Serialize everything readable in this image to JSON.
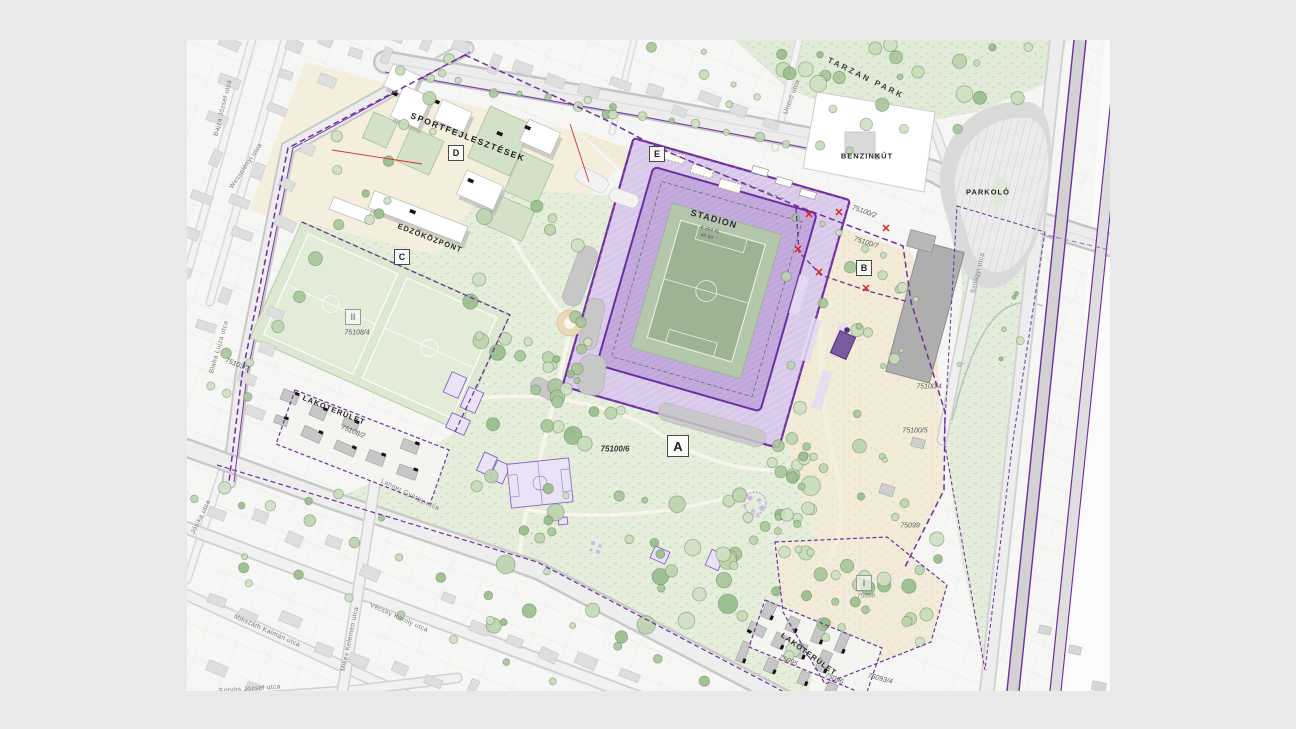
{
  "areas": {
    "sport": {
      "label": "SPORTFEJLESZTÉSEK"
    },
    "training": {
      "label": "EDZŐKÖZPONT"
    },
    "stadium": {
      "label": "STADION",
      "note1": "8 903 fő",
      "note2": "±0,00"
    },
    "residential_left": {
      "label": "LAKÓTERÜLET"
    },
    "residential_se": {
      "label": "LAKÓTERÜLET"
    },
    "gas_station": {
      "label": "BENZINKÚT"
    },
    "parking": {
      "label": "PARKOLÓ"
    },
    "tarzan_park": {
      "label": "TARZAN PARK"
    }
  },
  "zone_markers": {
    "a": "A",
    "b": "B",
    "c": "C",
    "d": "D",
    "e": "E",
    "one": "I",
    "two": "II"
  },
  "parcels": {
    "p75100_2": "75100/2",
    "p75100_7": "75100/7",
    "p75100_4": "75100/4",
    "p75100_5": "75100/5",
    "p75100_6": "75100/6",
    "p75108_4": "75108/4",
    "p75108_2": "75108/2",
    "p75103_3": "75103/3",
    "p75099": "75099",
    "p75098": "75098",
    "p75095": "75095",
    "p75096": "75096",
    "p75093_4": "75093/4"
  },
  "streets": {
    "bajza": "Bajza József utca",
    "wesselenyi": "Wesselényi utca",
    "blaha": "Blaha Lujza utca",
    "josika": "Jósika utca",
    "lahner": "Lahner György utca",
    "mikes": "Mikes Kelemen utca",
    "mikszath": "Mikszáth Kálmán utca",
    "eotvos": "Eötvös József utca",
    "vecsey": "Vécsey Károly utca",
    "szilagyi": "Szilágyi utca",
    "uttoro": "Úttörő utca"
  },
  "colors": {
    "boundary": "#7030a0",
    "stadium_fill": "#c3abdd",
    "plaza_fill": "#d8c8e9",
    "pitch_green": "#9cb493",
    "park_green": "#e5eddb",
    "sand": "#f2ebd8",
    "marker_red": "#e01818",
    "rail_gray": "#d4d4d4"
  }
}
